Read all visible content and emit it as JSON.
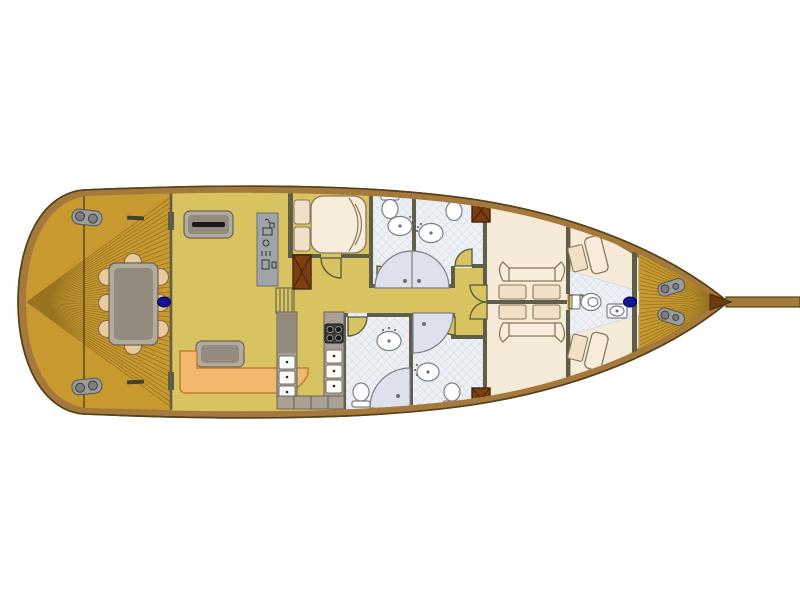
{
  "plan": {
    "vessel_type": "sailing-yacht-interior-deck-plan",
    "orientation": {
      "bow": "right",
      "stern": "left",
      "bowsprit": "extends to right edge"
    },
    "areas": [
      "aft-deck-dining",
      "salon",
      "nav-station",
      "galley",
      "mid-double-cabin",
      "corridor",
      "bathrooms-forward-pair",
      "bathrooms-aft-pair",
      "twin-double-cabins",
      "fore-vberth-cabin",
      "bow-deck"
    ],
    "counts": {
      "masts": 2,
      "dining_chairs": 8,
      "double_beds": 3,
      "v_berths": 2,
      "toilets": 5,
      "sinks": 5,
      "shower_stalls": 5,
      "stove_burners": 4,
      "deck_winches": 4,
      "companionway_steps": 5
    }
  },
  "colors": {
    "background": "#FFFFFF",
    "hull_wood": "#A5793B",
    "hull_outline": "#55431C",
    "deck_plank": "#C8992F",
    "plank_line": "#8F6D1E",
    "dark_wood": "#7A3E10",
    "interior_floor": "#D8C360",
    "wall": "#5E5E49",
    "cabin_floor": "#F6EAD8",
    "tile_floor": "#EDF0F5",
    "tile_line": "#D5DAE5",
    "shower_fill": "#DCE1EC",
    "fixture_white": "#FFFFFF",
    "fixture_outline": "#7A7F8A",
    "bed_cream": "#F8ECDC",
    "pillow_cream": "#F1E0C8",
    "bed_outline": "#8A7A5A",
    "sofa_orange": "#F3B76E",
    "sofa_outline": "#C08030",
    "furniture_gray": "#B3AA9E",
    "furniture_dark": "#948B7F",
    "furniture_outline": "#6B6355",
    "counter_gray": "#A9A095",
    "chair_tan": "#E9C99E",
    "chair_outline": "#8A6A3A",
    "mast_navy": "#14149A",
    "metal_gray": "#9C9C9C",
    "metal_dark": "#555555",
    "stove_dark": "#3A3A35"
  }
}
